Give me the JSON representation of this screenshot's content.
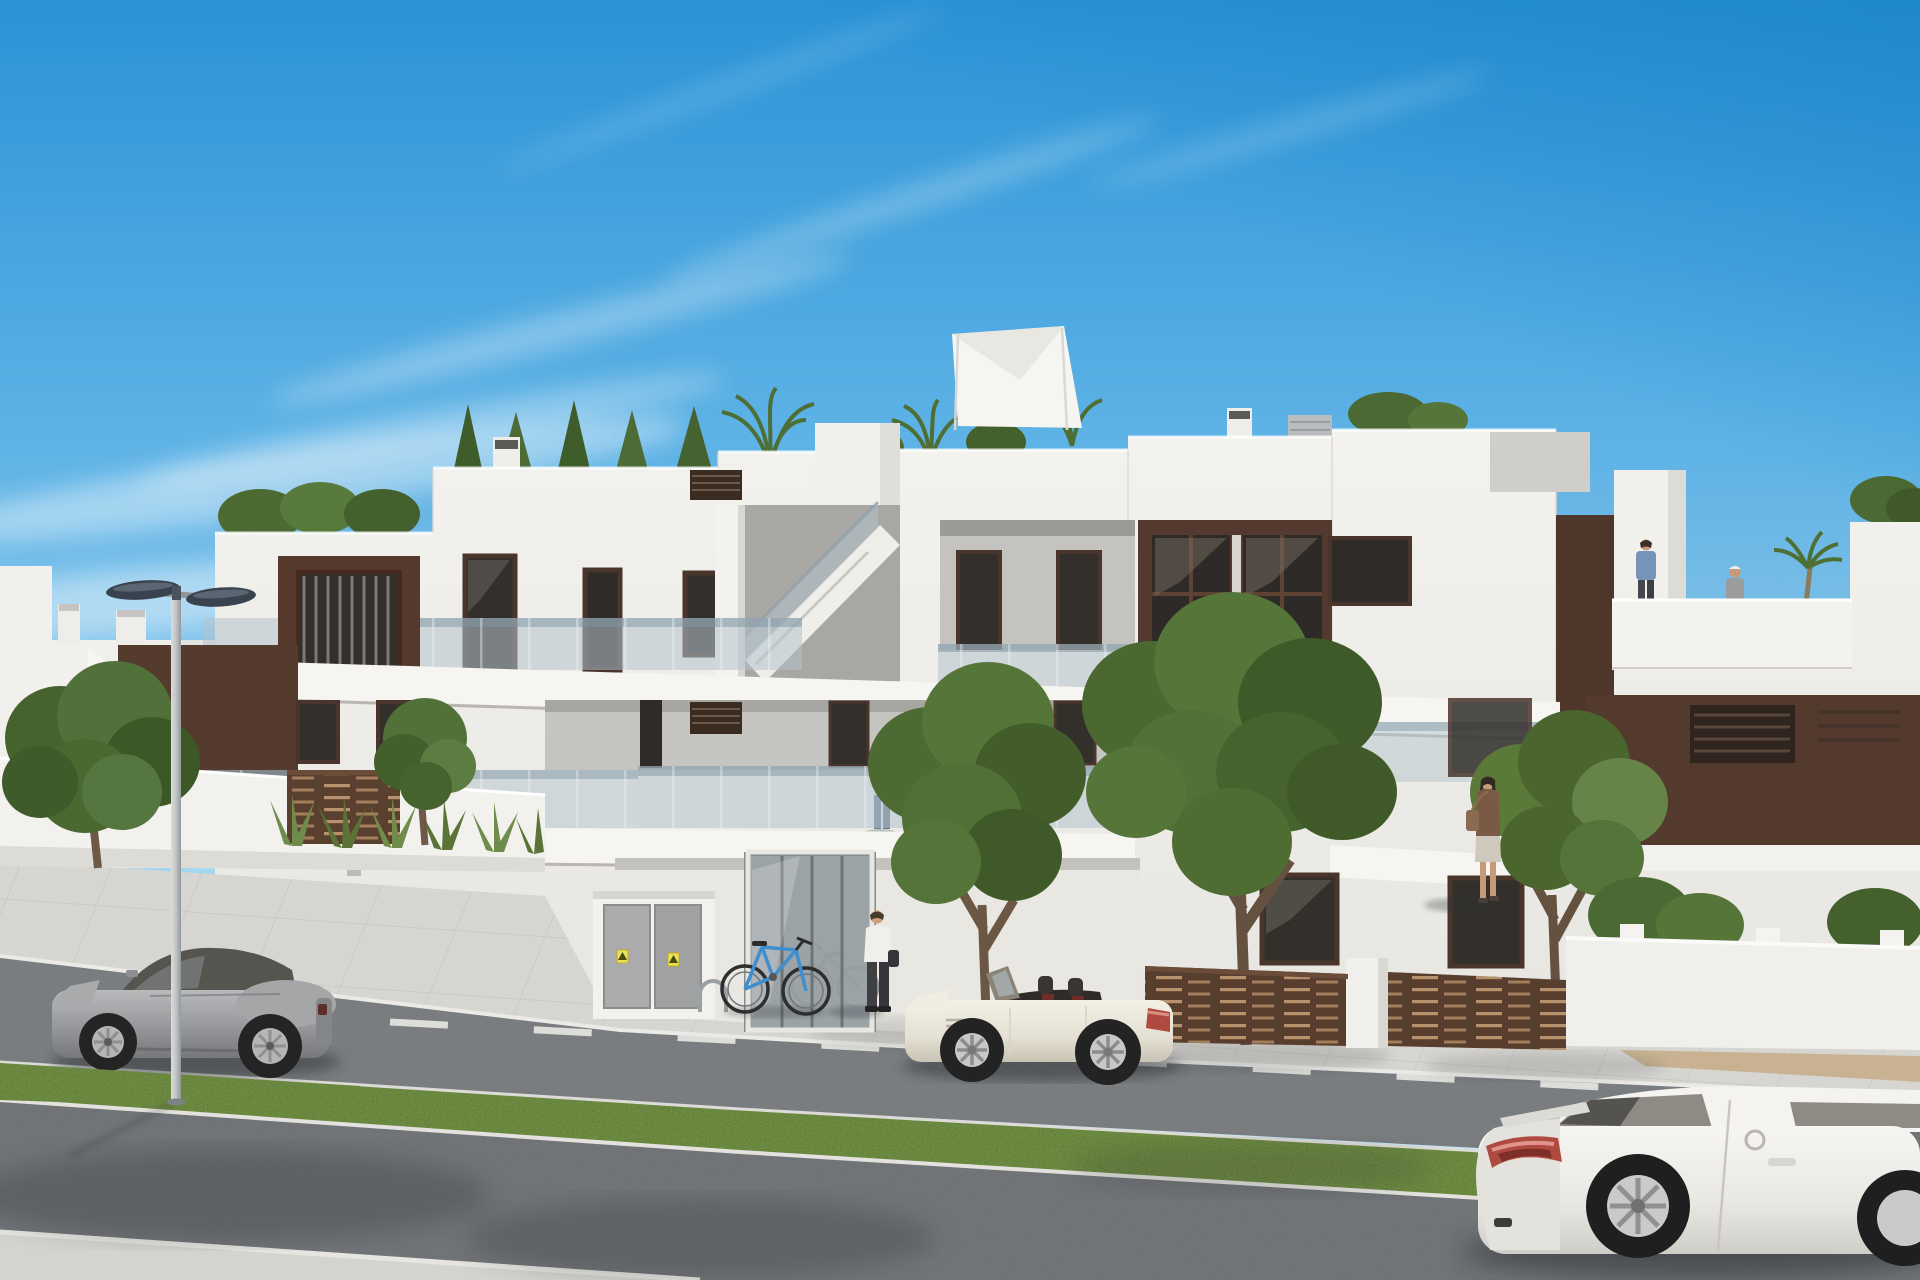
{
  "meta": {
    "title": "New-build apartment development, artist impression",
    "type": "architectural-3d-render",
    "time_of_day": "sunny day",
    "no_visible_text": true
  },
  "sky": {
    "label": "clear blue sky with wispy cirrus clouds",
    "top_color": "#2a93d6",
    "horizon_color": "#d9eef8",
    "cloud_color": "#ffffff"
  },
  "building": {
    "label": "modern white flat-roof apartment block with chocolate-brown accent panels",
    "floors_visible": 3,
    "wall_color": "#f3f2ee",
    "accent_panel_color": "#56392d",
    "window_frame_color": "#4a352c",
    "window_glass_color": "#33302c",
    "balustrade_glass_color": "#b4c3cc",
    "features": [
      "roof terraces with hedges and palm trees",
      "white shade sail on roof terrace",
      "external staircase to solarium",
      "frameless glass balcony balustrades",
      "brown louvre privacy fence panels",
      "glass entrance lobby",
      "utility cabinets with yellow warning stickers",
      "chimney stacks and AC unit on roof"
    ]
  },
  "roof_terrace": {
    "label": "right roof terrace with two residents and palm plant",
    "parapet_color": "#f3f2ee"
  },
  "vehicles": [
    {
      "label": "gray sports coupe parked at kerb",
      "body_color": "#9a9b9d",
      "state": "parked",
      "position": "left"
    },
    {
      "label": "cream convertible roadster with top down",
      "body_color": "#ece9df",
      "interior_color": "#2f2b28",
      "state": "parked",
      "position": "center"
    },
    {
      "label": "white sports coupe driving past",
      "body_color": "#f1f0ec",
      "taillight_color": "#b04a40",
      "state": "moving",
      "position": "bottom right, partly out of frame"
    }
  ],
  "people": [
    {
      "label": "woman holding baby on first-floor balcony",
      "clothing": "white top, blue jeans",
      "extra": "pink baby bundle"
    },
    {
      "label": "man on first-floor balcony",
      "clothing": "gray t-shirt, blue jeans"
    },
    {
      "label": "man walking toward entrance",
      "clothing": "white shirt, dark trousers, dark bag"
    },
    {
      "label": "man walking on roof terrace",
      "clothing": "blue shirt, dark trousers"
    },
    {
      "label": "woman standing on roof terrace",
      "clothing": "gray jacket, white cap"
    },
    {
      "label": "woman pedestrian on right sidewalk",
      "clothing": "brown top, light skirt, shoulder bag"
    }
  ],
  "street": {
    "label": "asphalt road with dashed white centre line, tiled sidewalk and grass median",
    "road_color": "#717477",
    "foreground_road_color": "#686b6e",
    "sidewalk_color": "#d6d5d1",
    "grass_color": "#5d7a32",
    "curb_color": "#ebeae6",
    "marking_color": "#e8e8e4",
    "sand_strip_color": "#c8b291"
  },
  "objects": {
    "street_light": {
      "label": "double-arm street light with two slate-blue lamp heads",
      "head_color": "#39434f",
      "pole_color": "#c7c9ca"
    },
    "bicycle_blue": {
      "label": "blue bicycle parked at rack",
      "frame_color": "#3e8ed0"
    },
    "bicycle_indoor": {
      "label": "gray bicycle behind entrance glass"
    },
    "bike_rack": {
      "label": "metal bicycle rack hoop"
    },
    "utility_cabinet": {
      "label": "white utility cabinet, two gray doors, two yellow warning stickers",
      "sticker_color": "#e6e35a"
    },
    "shade_sail": {
      "label": "white shade sail over roof terrace"
    },
    "entrance": {
      "label": "glass entrance lobby with mullions"
    }
  },
  "vegetation": {
    "label": "street trees, agave planting and roof hedges",
    "tree_greens": [
      "#46632e",
      "#52713a",
      "#3d5827",
      "#567539"
    ],
    "trunk_color": "#6b5744",
    "items": [
      "leafy tree far left",
      "agave row",
      "small tree by fence",
      "tall tree by entrance",
      "large tree centre-right",
      "tree by right sidewalk",
      "bushes behind right wall",
      "roof conifers and palms"
    ]
  }
}
